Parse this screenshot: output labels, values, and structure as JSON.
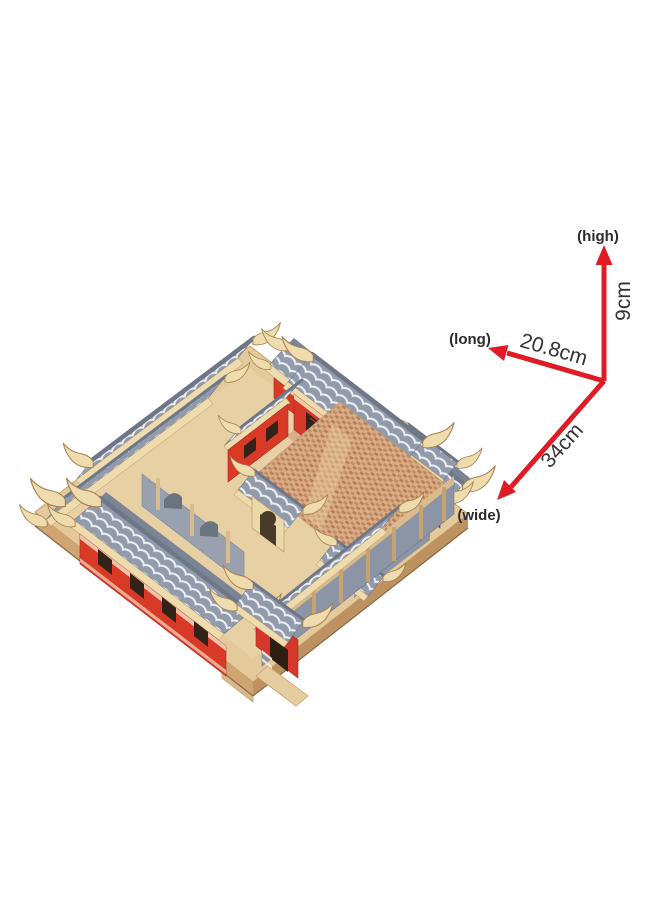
{
  "image": {
    "description": "Photo of a 3D wooden puzzle model of a traditional Chinese siheyuan courtyard house with gray scalloped tile roofs, red walls, upturned cream eaves, a speckled brick courtyard and a plywood base, annotated with red dimension arrows."
  },
  "dimensions": {
    "high": {
      "label": "(high)",
      "value": "9cm"
    },
    "long": {
      "label": "(long)",
      "value": "20.8cm"
    },
    "wide": {
      "label": "(wide)",
      "value": "34cm"
    }
  },
  "colors": {
    "arrow": "#e01b24",
    "label_text": "#2b2b2b",
    "value_text": "#333333",
    "roof_tile": "#919bac",
    "roof_ridge": "#6e7787",
    "wall_red": "#d93a28",
    "eave_trim": "#eedcae",
    "plywood_base": "#e3c99c",
    "courtyard_brick": "#d9ad88",
    "background": "#ffffff"
  }
}
